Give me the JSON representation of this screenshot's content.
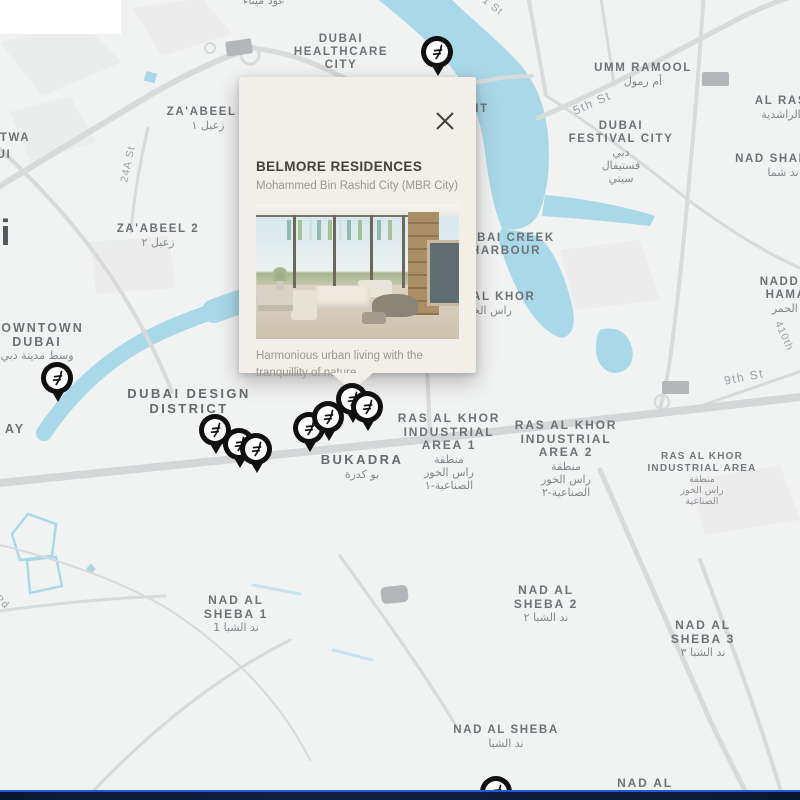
{
  "popup": {
    "title": "BELMORE RESIDENCES",
    "subtitle": "Mohammed Bin Rashid City (MBR City)",
    "description": "Harmonious urban living with the tranquillity of nature"
  },
  "colors": {
    "water": "#a9d8e9",
    "road": "#d9dadb",
    "district_label": "#6e7277",
    "arabic_label": "#84888d",
    "street_label": "#9ba1a7",
    "popup_background": "#f2efe9",
    "pin": "#101010",
    "bottom_bar": "#0c1830",
    "bottom_bar_accent": "#2456d8",
    "placeholder_box": "#b4b7ba"
  },
  "map": {
    "labels": [
      {
        "name": "label-oud-metha",
        "x": 264,
        "y": -6,
        "lines": [
          {
            "t": "عود ميثاء",
            "s": "ar"
          }
        ]
      },
      {
        "name": "street-01-st",
        "x": 490,
        "y": -2,
        "rotate": 38,
        "lines": [
          {
            "t": "01 St",
            "s": "street"
          }
        ]
      },
      {
        "name": "label-dubai-healthcare-city",
        "x": 341,
        "y": 33,
        "lines": [
          {
            "t": "DUBAI",
            "s": "d1"
          },
          {
            "t": "HEALTHCARE",
            "s": "d1"
          },
          {
            "t": "CITY",
            "s": "d1"
          }
        ]
      },
      {
        "name": "label-umm-ramool",
        "x": 643,
        "y": 62,
        "lines": [
          {
            "t": "UMM RAMOOL",
            "s": "d1"
          },
          {
            "t": "أم رمول",
            "s": "ar"
          }
        ]
      },
      {
        "name": "label-al-ras",
        "x": 781,
        "y": 95,
        "lines": [
          {
            "t": "AL RAS",
            "s": "d1"
          },
          {
            "t": "الراشدية",
            "s": "ar"
          }
        ]
      },
      {
        "name": "label-nad-shamma",
        "x": 783,
        "y": 153,
        "lines": [
          {
            "t": "NAD SHAMMA",
            "s": "d1"
          },
          {
            "t": "ند شما",
            "s": "ar"
          }
        ]
      },
      {
        "name": "label-dubai-festival-city",
        "x": 621,
        "y": 120,
        "lines": [
          {
            "t": "DUBAI",
            "s": "d1"
          },
          {
            "t": "FESTIVAL CITY",
            "s": "d1"
          },
          {
            "t": "دبي",
            "s": "ar"
          },
          {
            "t": "فستيفال",
            "s": "ar"
          },
          {
            "t": "سيتي",
            "s": "ar"
          }
        ]
      },
      {
        "name": "label-zaabeel-1",
        "x": 208,
        "y": 106,
        "lines": [
          {
            "t": "ZA'ABEEL 1",
            "s": "d1"
          },
          {
            "t": "زعبل ١",
            "s": "ar"
          }
        ]
      },
      {
        "name": "label-zaabeel-2",
        "x": 158,
        "y": 223,
        "lines": [
          {
            "t": "ZA'ABEEL 2",
            "s": "d1"
          },
          {
            "t": "زعبل ٢",
            "s": "ar"
          }
        ]
      },
      {
        "name": "label-satwa-partial",
        "x": 15,
        "y": 132,
        "lines": [
          {
            "t": "TWA",
            "s": "d1"
          }
        ]
      },
      {
        "name": "label-satwa-partial-2",
        "x": 4,
        "y": 149,
        "lines": [
          {
            "t": "UI",
            "s": "d1"
          }
        ]
      },
      {
        "name": "label-city-partial-i",
        "x": 6,
        "y": 215,
        "lines": [
          {
            "t": "i",
            "s": "big"
          }
        ]
      },
      {
        "name": "label-downtown-dubai",
        "x": 37,
        "y": 322,
        "lines": [
          {
            "t": "DOWNTOWN",
            "s": "d2s"
          },
          {
            "t": "DUBAI",
            "s": "d2s"
          },
          {
            "t": "وسط مدينة دبي",
            "s": "ar"
          }
        ]
      },
      {
        "name": "label-bay-partial",
        "x": 15,
        "y": 423,
        "lines": [
          {
            "t": "AY",
            "s": "d2s"
          }
        ]
      },
      {
        "name": "street-24a-st",
        "x": 128,
        "y": 158,
        "rotate": -78,
        "lines": [
          {
            "t": "24A St",
            "s": "street"
          }
        ]
      },
      {
        "name": "street-5th-st",
        "x": 592,
        "y": 96,
        "rotate": -24,
        "lines": [
          {
            "t": "5th St",
            "s": "street2"
          }
        ]
      },
      {
        "name": "label-dubai-design-district",
        "x": 189,
        "y": 387,
        "lines": [
          {
            "t": "DUBAI DESIGN",
            "s": "d2"
          },
          {
            "t": "DISTRICT",
            "s": "d2"
          }
        ]
      },
      {
        "name": "label-bukadra",
        "x": 362,
        "y": 453,
        "lines": [
          {
            "t": "BUKADRA",
            "s": "d2"
          },
          {
            "t": "بو كدرة",
            "s": "ar"
          }
        ]
      },
      {
        "name": "label-ras-al-khor-industrial-1",
        "x": 449,
        "y": 412,
        "lines": [
          {
            "t": "RAS AL KHOR",
            "s": "d1b"
          },
          {
            "t": "INDUSTRIAL",
            "s": "d1b"
          },
          {
            "t": "AREA 1",
            "s": "d1b"
          },
          {
            "t": "منطقة",
            "s": "ar"
          },
          {
            "t": "راس الخور",
            "s": "ar"
          },
          {
            "t": "الصناعية-١",
            "s": "ar"
          }
        ]
      },
      {
        "name": "label-ras-al-khor-industrial-2",
        "x": 566,
        "y": 419,
        "lines": [
          {
            "t": "RAS AL KHOR",
            "s": "d1b"
          },
          {
            "t": "INDUSTRIAL",
            "s": "d1b"
          },
          {
            "t": "AREA 2",
            "s": "d1b"
          },
          {
            "t": "منطقة",
            "s": "ar"
          },
          {
            "t": "راس الخور",
            "s": "ar"
          },
          {
            "t": "الصناعية-٢",
            "s": "ar"
          }
        ]
      },
      {
        "name": "label-ras-al-khor-industrial-area",
        "x": 702,
        "y": 451,
        "lines": [
          {
            "t": "RAS AL KHOR",
            "s": "d3"
          },
          {
            "t": "INDUSTRIAL AREA",
            "s": "d3"
          },
          {
            "t": "منطقة",
            "s": "ar3"
          },
          {
            "t": "راس الخور",
            "s": "ar3"
          },
          {
            "t": "الصناعية",
            "s": "ar3"
          }
        ]
      },
      {
        "name": "label-nadd-al-hamar",
        "x": 791,
        "y": 276,
        "lines": [
          {
            "t": "NADD AL",
            "s": "d1"
          },
          {
            "t": "HAMAR",
            "s": "d1"
          },
          {
            "t": "ند الحمر",
            "s": "ar"
          }
        ]
      },
      {
        "name": "label-ras-al-khor",
        "x": 487,
        "y": 291,
        "lines": [
          {
            "t": "RAS AL KHOR",
            "s": "d1"
          },
          {
            "t": "راس الخور",
            "s": "ar"
          }
        ]
      },
      {
        "name": "label-dubai-creek-harbour",
        "x": 506,
        "y": 232,
        "lines": [
          {
            "t": "DUBAI CREEK",
            "s": "d1"
          },
          {
            "t": "HARBOUR",
            "s": "d1"
          }
        ]
      },
      {
        "name": "label-it-partial",
        "x": 482,
        "y": 103,
        "lines": [
          {
            "t": "IT",
            "s": "d1"
          }
        ]
      },
      {
        "name": "street-9th-st",
        "x": 744,
        "y": 370,
        "rotate": -11,
        "lines": [
          {
            "t": "9th St",
            "s": "street2"
          }
        ]
      },
      {
        "name": "street-410",
        "x": 784,
        "y": 330,
        "rotate": 66,
        "lines": [
          {
            "t": "410th",
            "s": "street"
          }
        ]
      },
      {
        "name": "street-rd",
        "x": 2,
        "y": 596,
        "rotate": 42,
        "lines": [
          {
            "t": "Rd",
            "s": "street"
          }
        ]
      },
      {
        "name": "label-nad-al-sheba-1",
        "x": 236,
        "y": 594,
        "lines": [
          {
            "t": "NAD AL",
            "s": "d1b"
          },
          {
            "t": "SHEBA 1",
            "s": "d1b"
          },
          {
            "t": "ند الشبا 1",
            "s": "ar"
          }
        ]
      },
      {
        "name": "label-nad-al-sheba-2",
        "x": 546,
        "y": 584,
        "lines": [
          {
            "t": "NAD AL",
            "s": "d1b"
          },
          {
            "t": "SHEBA 2",
            "s": "d1b"
          },
          {
            "t": "ند الشبا ٢",
            "s": "ar"
          }
        ]
      },
      {
        "name": "label-nad-al-sheba-3",
        "x": 703,
        "y": 619,
        "lines": [
          {
            "t": "NAD AL",
            "s": "d1b"
          },
          {
            "t": "SHEBA 3",
            "s": "d1b"
          },
          {
            "t": "ند الشبا ٣",
            "s": "ar"
          }
        ]
      },
      {
        "name": "label-nad-al-sheba",
        "x": 506,
        "y": 724,
        "lines": [
          {
            "t": "NAD AL SHEBA",
            "s": "d1"
          },
          {
            "t": "ند الشبا",
            "s": "ar"
          }
        ]
      },
      {
        "name": "label-nad-al-sheba-4",
        "x": 645,
        "y": 777,
        "lines": [
          {
            "t": "NAD AL",
            "s": "d1b"
          },
          {
            "t": "SHEBA 4",
            "s": "d1b"
          }
        ]
      }
    ],
    "pins": [
      {
        "x": 438,
        "y": 52
      },
      {
        "x": 58,
        "y": 378
      },
      {
        "x": 216,
        "y": 430
      },
      {
        "x": 240,
        "y": 444
      },
      {
        "x": 257,
        "y": 449
      },
      {
        "x": 310,
        "y": 428
      },
      {
        "x": 329,
        "y": 417
      },
      {
        "x": 353,
        "y": 399
      },
      {
        "x": 368,
        "y": 407
      },
      {
        "x": 497,
        "y": 792
      }
    ],
    "placeholders": [
      {
        "x": 226,
        "y": 40,
        "w": 26,
        "h": 15,
        "rot": -8,
        "rad": 2
      },
      {
        "x": 702,
        "y": 72,
        "w": 27,
        "h": 14,
        "rot": 0,
        "rad": 2
      },
      {
        "x": 662,
        "y": 381,
        "w": 27,
        "h": 13,
        "rot": 0,
        "rad": 2
      },
      {
        "x": 381,
        "y": 586,
        "w": 27,
        "h": 17,
        "rot": -6,
        "rad": 5
      }
    ],
    "white_patch": {
      "x": 0,
      "y": 0,
      "w": 121,
      "h": 34
    }
  }
}
